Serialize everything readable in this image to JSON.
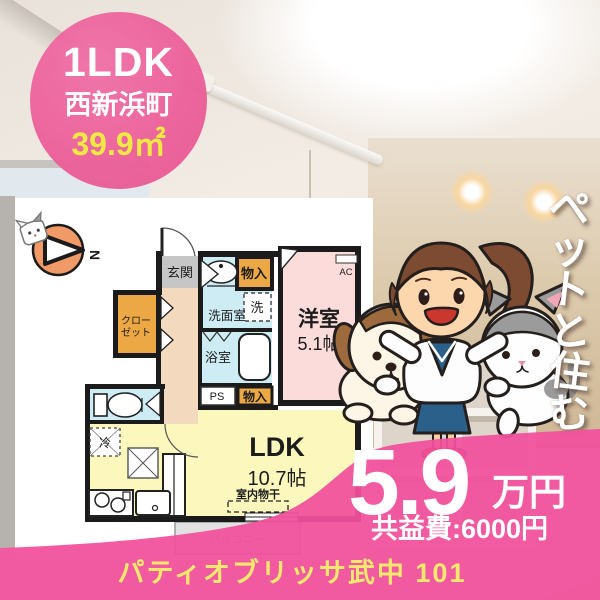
{
  "badge": {
    "type": "1LDK",
    "location": "西新浜町",
    "area": "39.9㎡"
  },
  "tagline": {
    "chars": [
      "ペ",
      "ッ",
      "ト",
      "と",
      "住",
      "む"
    ]
  },
  "price": {
    "rent": "5.9",
    "unit": "万円",
    "fee": "共益費:6000円"
  },
  "footer": {
    "building": "パティオブリッサ武中 101"
  },
  "floorplan": {
    "compass": "N",
    "labels": {
      "genkan": "玄関",
      "monoire_top": "物入",
      "senmen": "洗面室",
      "sen": "洗",
      "yokushitsu": "浴室",
      "ps": "PS",
      "monoire_btm": "物入",
      "yoshitsu": "洋室",
      "yoshitsu_size": "5.1帖",
      "ac": "AC",
      "closet1": "クロー",
      "closet2": "ゼット",
      "rei": "冷",
      "ldk": "LDK",
      "ldk_size": "10.7帖",
      "monohoshi": "室内物干",
      "balcony": "バルコニー"
    }
  },
  "colors": {
    "accent_pink": "#f1519c",
    "circle_pink": "#ec629b",
    "highlight_yellow": "#f2ea3e",
    "footer_yellow": "#f5e96d"
  }
}
